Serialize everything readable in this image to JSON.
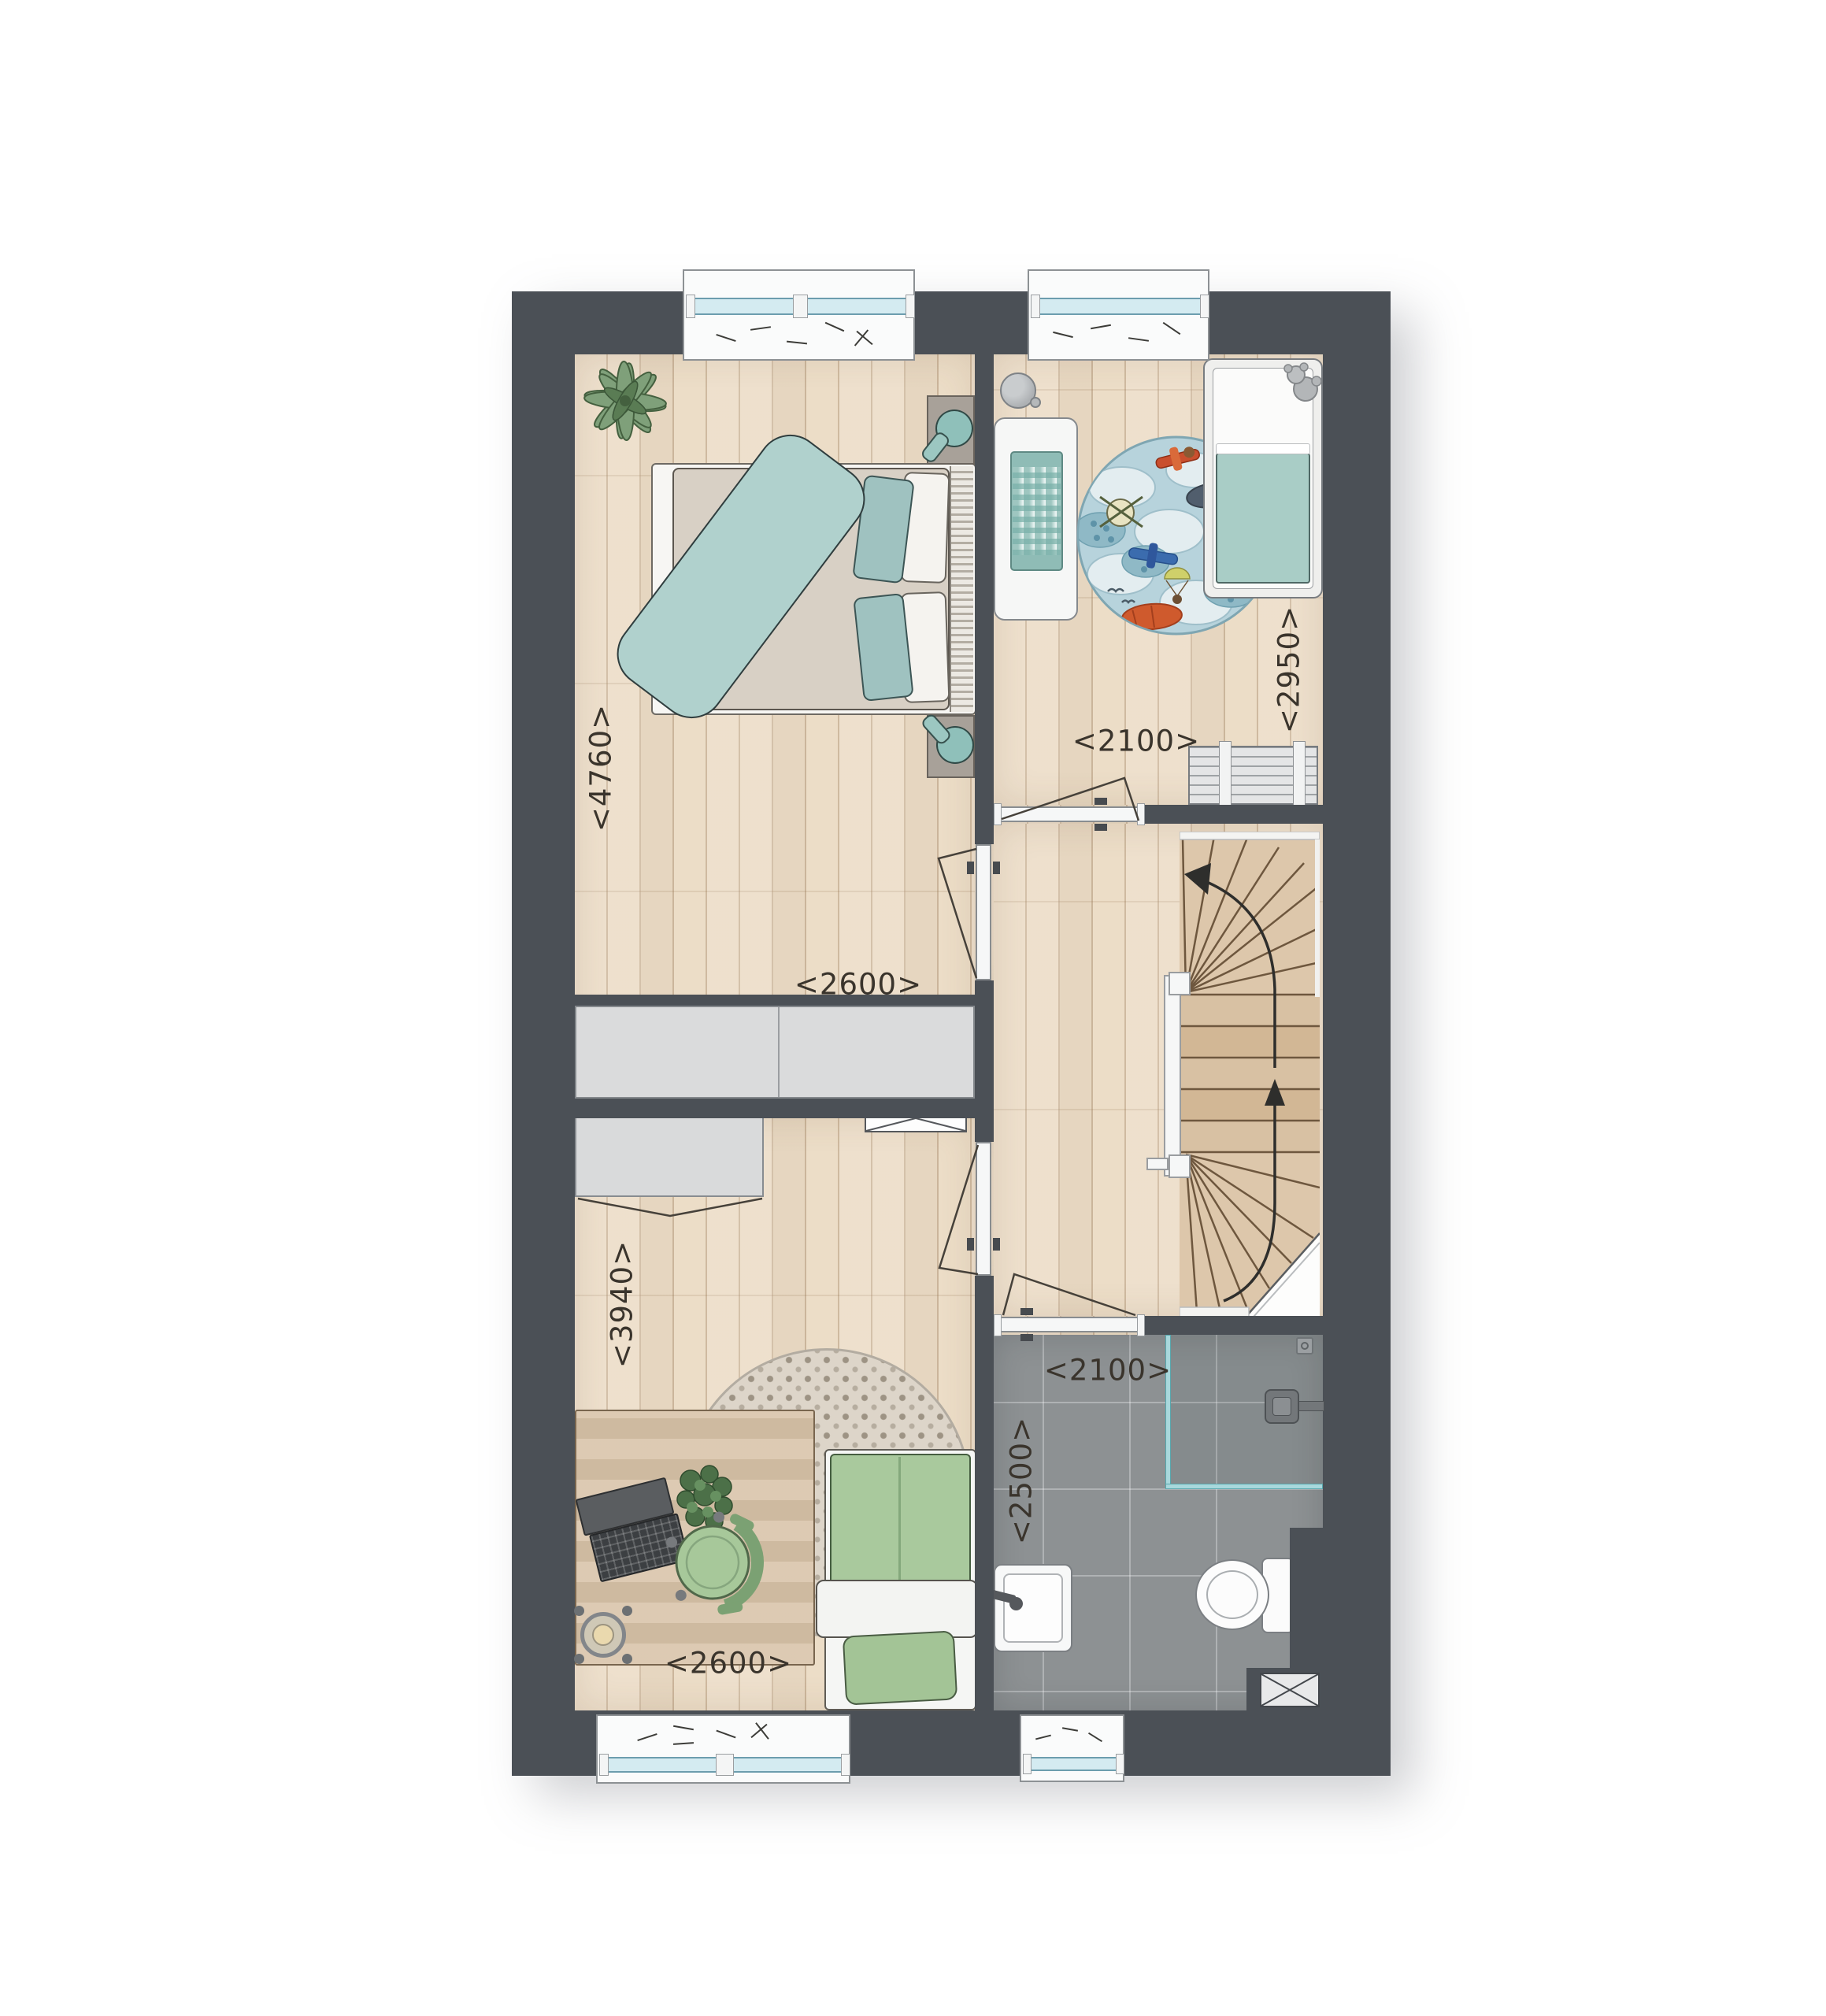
{
  "plan": {
    "type": "residential-floor-plan-upper-storey",
    "colors": {
      "wall": "#4b5056",
      "wood_floor": "#ecddc7",
      "bathroom_tile": "#8d9193",
      "accent_teal": "#a9cdc9",
      "accent_green": "#a5c89c",
      "dimension_text": "#3a342c"
    },
    "rooms": [
      {
        "id": "master-bedroom",
        "depth_label": "<4760>",
        "width_label": "<2600>",
        "furniture": [
          "double-bed",
          "teal-blanket",
          "pillows",
          "nightstand-with-lamp",
          "nightstand-with-lamp",
          "wardrobe",
          "fern-plant",
          "window"
        ]
      },
      {
        "id": "kids-room",
        "depth_label": "<2950>",
        "width_label": "<2100>",
        "furniture": [
          "crib",
          "teddy-bear",
          "round-play-rug",
          "changing-bench",
          "gingham-mat",
          "dresser",
          "ball",
          "window"
        ]
      },
      {
        "id": "teen-bedroom",
        "depth_label": "<3940>",
        "width_label": "<2600>",
        "furniture": [
          "single-bed",
          "round-area-rug",
          "desk",
          "desk-chair",
          "laptop",
          "stool",
          "desk-plant",
          "wardrobe",
          "vent-box",
          "window"
        ]
      },
      {
        "id": "bathroom",
        "width_label": "<2100>",
        "depth_label": "<2500>",
        "furniture": [
          "shower",
          "shower-head",
          "floor-drain",
          "toilet",
          "washbasin",
          "duct-shaft",
          "window"
        ]
      }
    ],
    "stairs": {
      "shape": "winder-staircase",
      "direction": "up"
    }
  }
}
